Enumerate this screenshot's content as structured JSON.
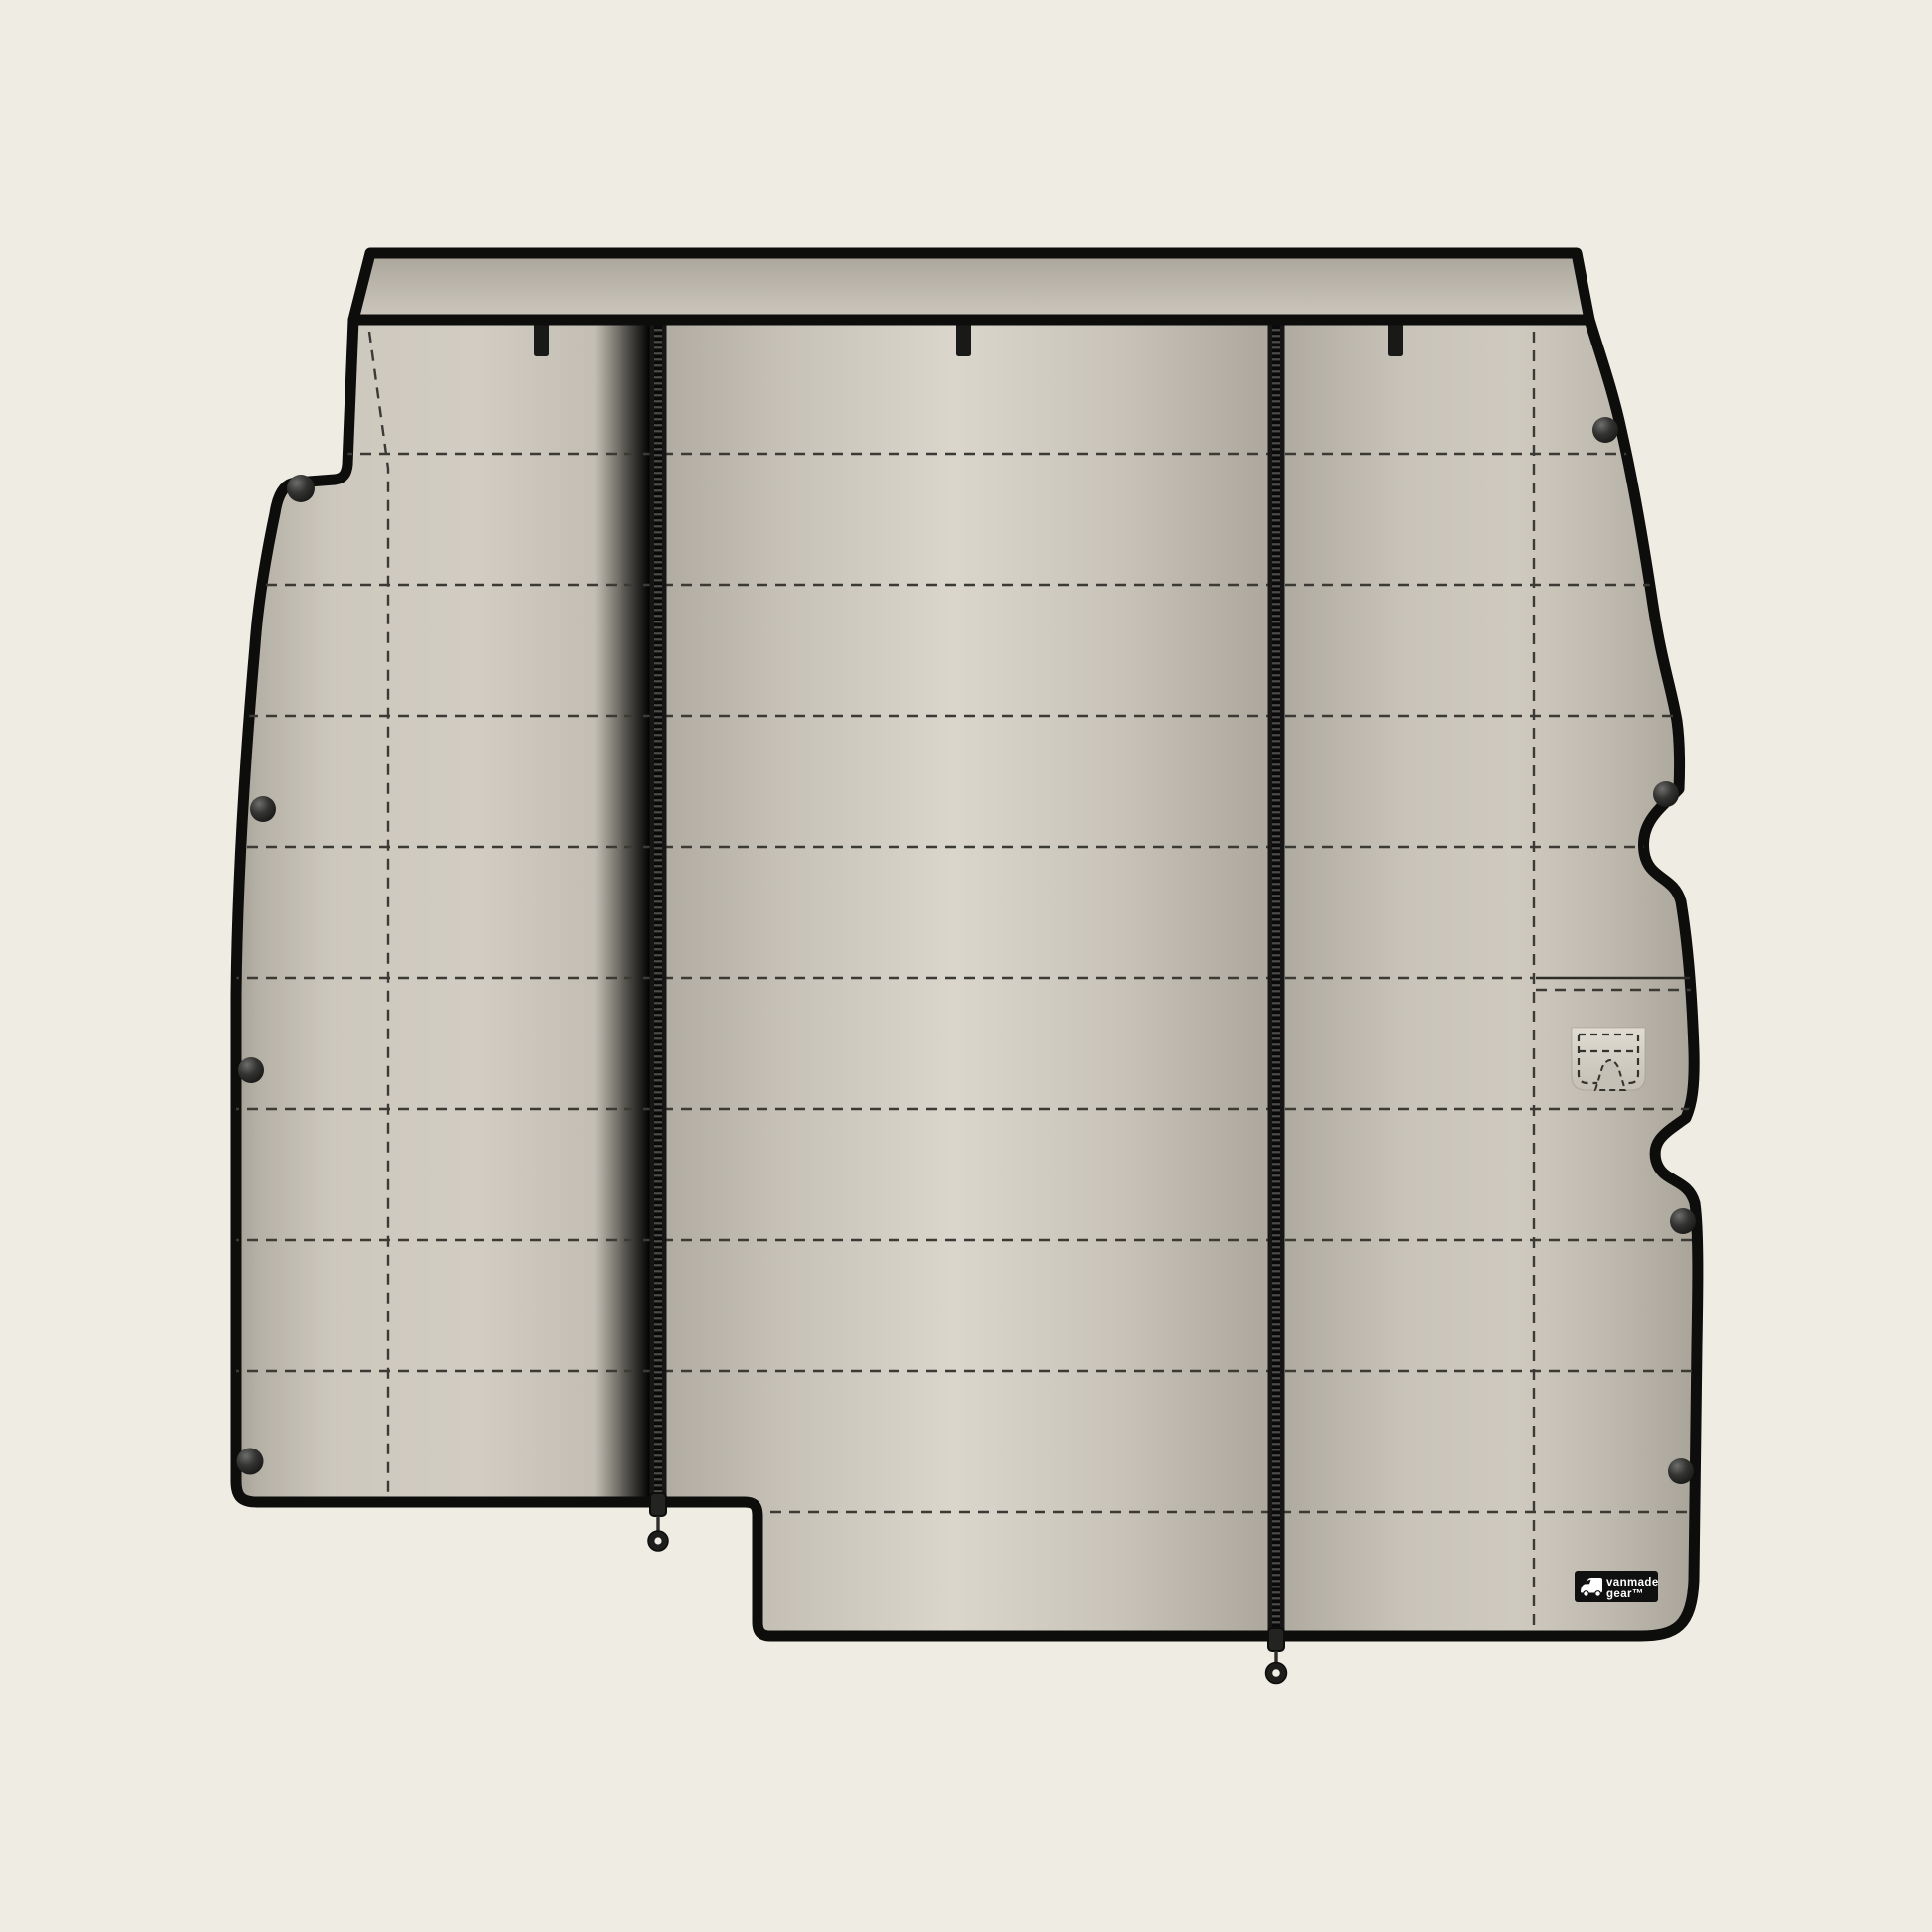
{
  "illustration": {
    "description": "Flat product illustration of a quilted van wall liner panel with zippers, snap fasteners, hang tabs and a handle cutout flap",
    "components": {
      "hang_tabs": 3,
      "zippers": 2,
      "zipper_pulls": 2,
      "snap_buttons": 8,
      "stitch_rows": 9,
      "stitch_columns": 2,
      "handle_cutout_flaps": 1,
      "logo_patches": 1
    }
  },
  "logo": {
    "line1": "vanmade",
    "line2": "gear™",
    "icon": "van-icon"
  },
  "colors": {
    "background": "#efece3",
    "outline": "#0d0d0c",
    "fabric_base": "#c6c1b6",
    "fabric_light": "#dad6cc",
    "fabric_dark": "#a8a298",
    "band_dark": "#aaa59a",
    "band_light": "#cdc8bd",
    "stitch": "#3b3a35",
    "zipper": "#161616",
    "snap": "#1b1b1b",
    "patch_bg": "#101010",
    "patch_text": "#ffffff"
  }
}
